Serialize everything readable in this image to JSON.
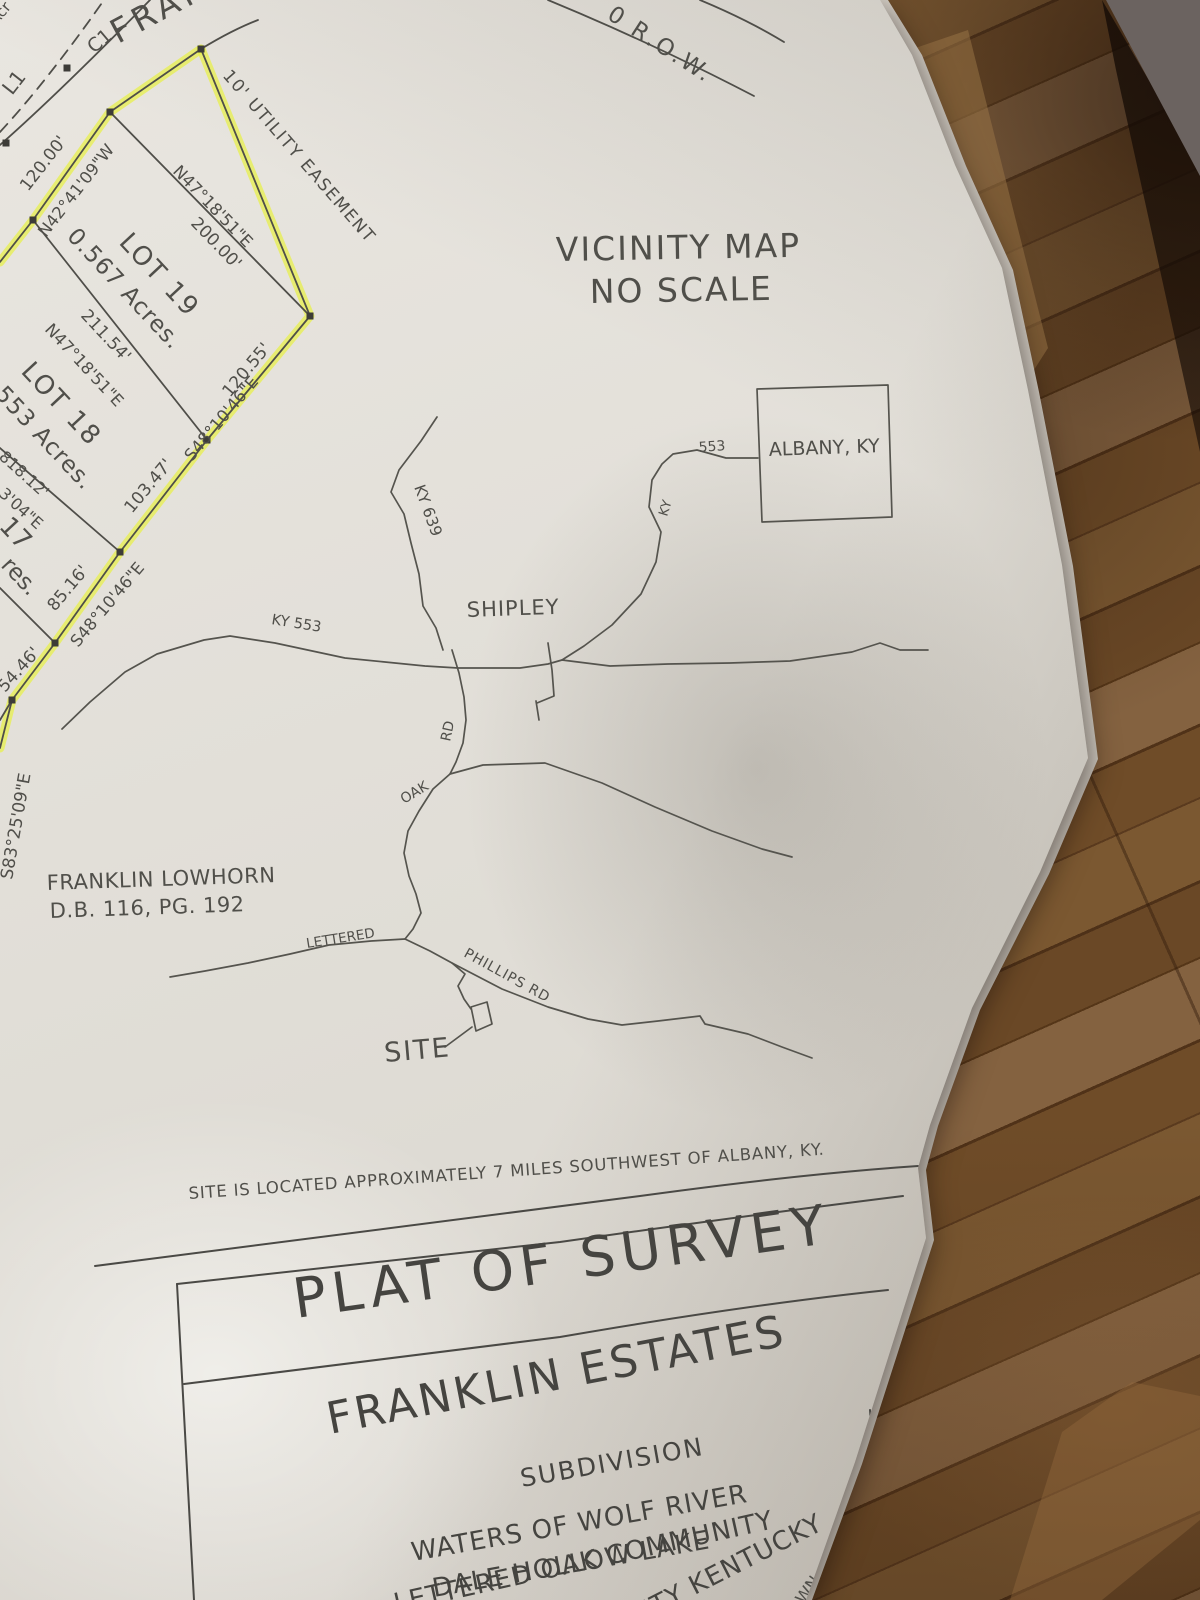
{
  "colors": {
    "highlight": "#e8f046",
    "ink": "#4f4e49",
    "paper": "#e6e3dd",
    "wood_mid": "#6f4c28",
    "wood_dark": "#5a3a1e",
    "wood_light": "#846240"
  },
  "plat": {
    "corner_partial": "Acr",
    "l1": "L1",
    "c1": "C1",
    "road_name_partial": "FRAN",
    "row_label": "0  R.O.W.",
    "easement": "10' UTILITY EASEMENT",
    "lot19_name": "LOT 19",
    "lot19_area": "0.567  Acres.",
    "lot18_name": "LOT 18",
    "lot18_area": "553  Acres.",
    "lot17_partial": "17",
    "lot17_area_partial": "res.",
    "dim_120": "120.00'",
    "brg_n42": "N42°41'09\"W",
    "brg_n47_a": "N47°18'51\"E",
    "dim_200": "200.00'",
    "dim_211": "211.54'",
    "brg_n47_b": "N47°18'51\"E",
    "dim_120_55": "120.55'",
    "brg_s48_a": "S48°10'46\"E",
    "dim_103": "103.47'",
    "dim_85": "85.16'",
    "brg_s48_b": "S48°10'46\"E",
    "dim_54": "54.46'",
    "brg_s83": "S83°25'09\"E",
    "dim_818": "818.12'",
    "brg_304": "3'04\"E"
  },
  "vicinity": {
    "title_line1": "VICINITY MAP",
    "title_line2": "NO SCALE",
    "albany_label": "ALBANY, KY",
    "route_553": "553",
    "ky_vertical": "KY",
    "ky_639": "KY 639",
    "shipley": "SHIPLEY",
    "ky_553": "KY 553",
    "oak": "OAK",
    "rd": "RD",
    "lettered": "LETTERED",
    "phillips_rd": "PHILLIPS RD",
    "site": "SITE"
  },
  "owner": {
    "name": "FRANKLIN LOWHORN",
    "deed": "D.B. 116, PG. 192"
  },
  "note": {
    "text": "SITE IS LOCATED APPROXIMATELY 7 MILES SOUTHWEST OF ALBANY, KY."
  },
  "title_block": {
    "title": "PLAT OF SURVEY",
    "name": "FRANKLIN ESTATES",
    "type": "SUBDIVISION",
    "waters_line1": "WATERS OF WOLF RIVER",
    "waters_line2": "DALE HOLLOW LAKE",
    "community": "LETTERED OAK COMMUNITY",
    "county_partial": "NTY KENTUCKY",
    "drawn_partial": "AWN"
  }
}
